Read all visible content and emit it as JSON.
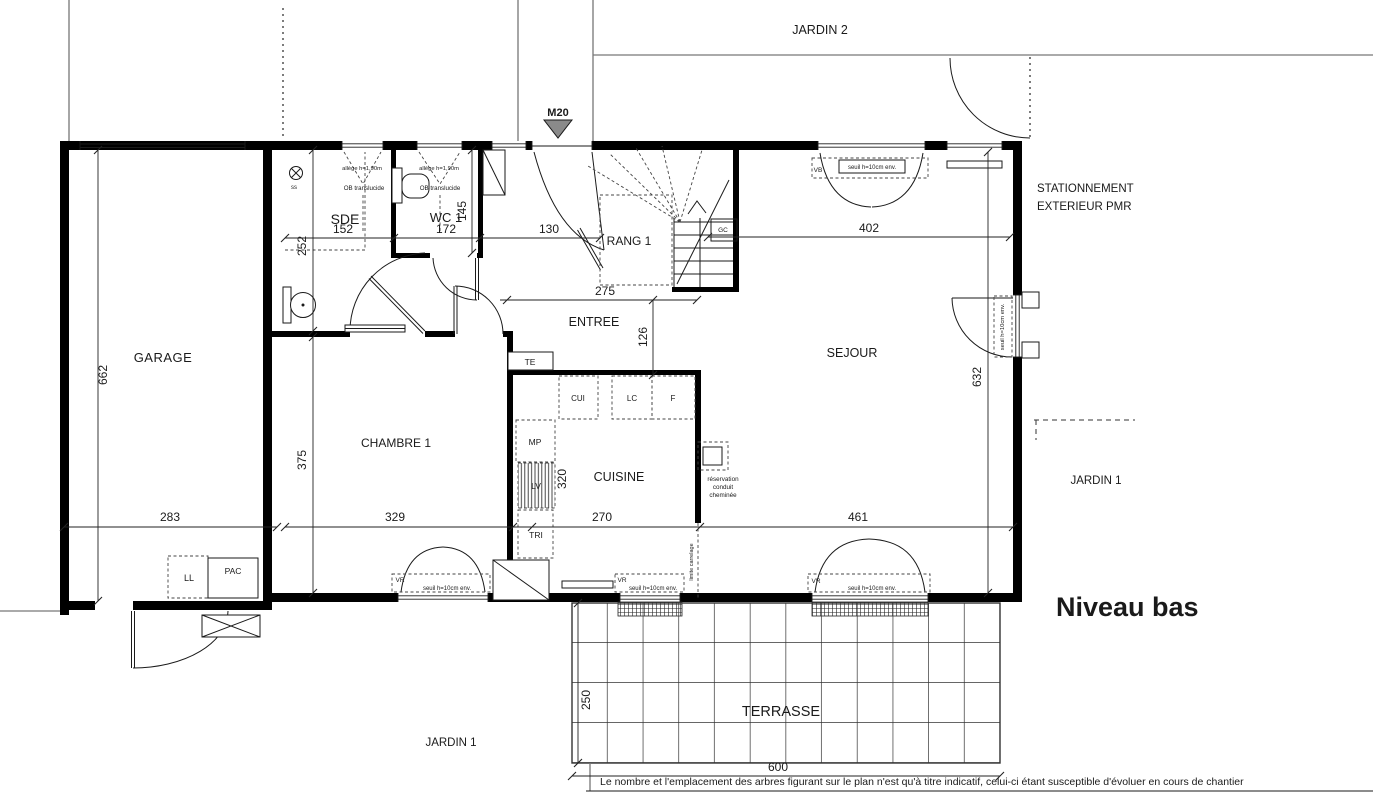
{
  "title": "Niveau bas",
  "palette": {
    "ink": "#1a1a1a",
    "wall": "#000000",
    "site_line": "#777777",
    "marker_fill": "#8a8a8a"
  },
  "site": {
    "jardin2": "JARDIN 2",
    "jardin1_right": "JARDIN 1",
    "jardin1_bottom": "JARDIN 1",
    "stationnement_line1": "STATIONNEMENT",
    "stationnement_line2": "EXTERIEUR PMR",
    "terrasse": "TERRASSE",
    "marker_m20": "M20",
    "disclaimer": "Le nombre et l'emplacement des arbres figurant sur le plan n'est qu'à titre indicatif, celui-ci étant susceptible d'évoluer en cours de chantier"
  },
  "rooms": {
    "garage": "GARAGE",
    "sde": "SDE",
    "wc1": "WC 1",
    "rang1": "RANG 1",
    "entree": "ENTREE",
    "sejour": "SEJOUR",
    "chambre1": "CHAMBRE 1",
    "cuisine": "CUISINE"
  },
  "dimensions_cm": {
    "garage_height": "662",
    "garage_width": "283",
    "sde_width": "152",
    "sde_height": "252",
    "wc_width": "172",
    "wc_height": "145",
    "hall_width": "130",
    "entree_width": "275",
    "entree_depth": "126",
    "sejour_top": "402",
    "sejour_height": "632",
    "sejour_bottom": "461",
    "chambre_width": "329",
    "chambre_height": "375",
    "cuisine_width": "270",
    "cuisine_height": "320",
    "terrasse_depth": "250",
    "terrasse_width": "600"
  },
  "equipment": {
    "te": "TE",
    "cui": "CUI",
    "lc": "LC",
    "f": "F",
    "mp": "MP",
    "lv": "LV",
    "tri": "TRI",
    "ll": "LL",
    "pac": "PAC",
    "gc": "GC",
    "ss": "ss",
    "reservation_line1": "réservation",
    "reservation_line2": "conduit",
    "reservation_line3": "cheminée",
    "limite_carrelage": "limite carrelage"
  },
  "openings": {
    "vb": "VB",
    "vr": "VR",
    "seuil": "seuil h=10cm env.",
    "allege": "allège h=1,90m",
    "ob": "OB translucide"
  }
}
